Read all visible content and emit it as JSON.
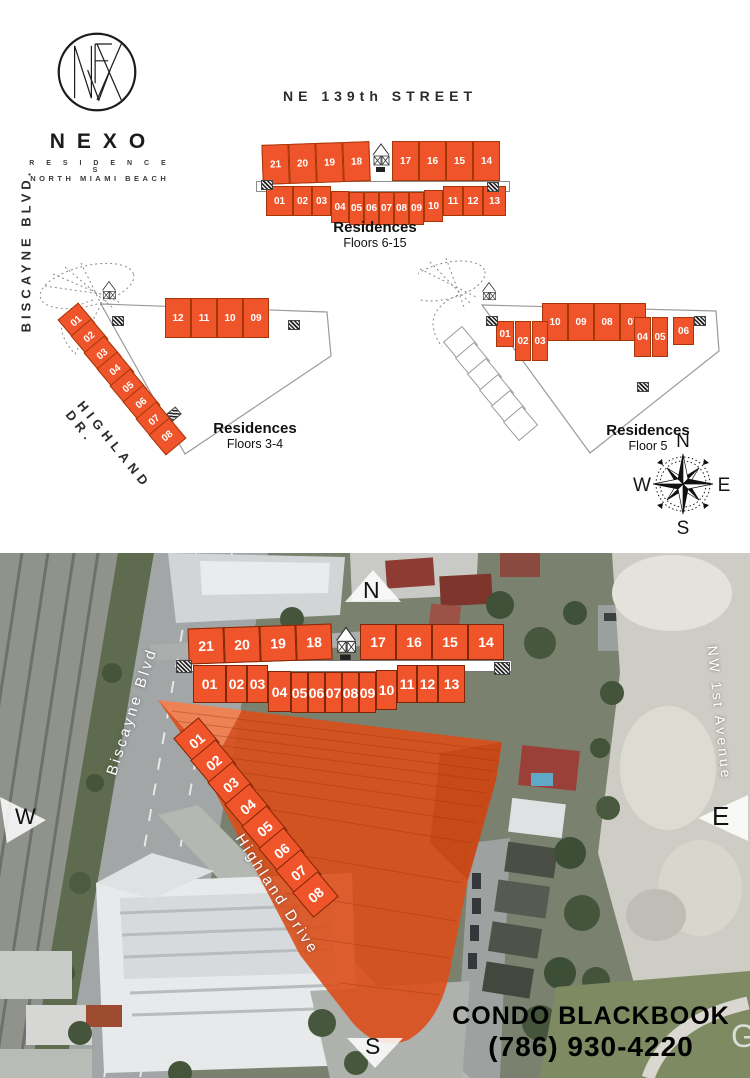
{
  "brand": {
    "name": "NEXO",
    "tagline_line1": "R E S I D E N C E S",
    "tagline_line2": "NORTH MIAMI BEACH"
  },
  "streets": {
    "ne139": "NE 139th STREET",
    "biscayne_blvd_plan": "BISCAYNE BLVD.",
    "highland_dr_plan": "HIGHLAND DR.",
    "biscayne_blvd_aerial": "Biscayne Blvd",
    "highland_drive_aerial": "Highland Drive",
    "nw_first_avenue": "NW 1st Avenue"
  },
  "keyplans": {
    "floors_6_15": {
      "title": "Residences",
      "subtitle": "Floors 6-15",
      "top_row_left": [
        "21",
        "20",
        "19",
        "18"
      ],
      "top_row_right": [
        "17",
        "16",
        "15",
        "14"
      ],
      "bottom_row": [
        "01",
        "02",
        "03",
        "04",
        "05",
        "06",
        "07",
        "08",
        "09",
        "10",
        "11",
        "12",
        "13"
      ]
    },
    "floors_3_4": {
      "title": "Residences",
      "subtitle": "Floors 3-4",
      "top_row_left": [
        "16",
        "15",
        "14",
        "13"
      ],
      "top_row_right": [
        "12",
        "11",
        "10",
        "09"
      ],
      "diagonal_units": [
        "01",
        "02",
        "03",
        "04",
        "05",
        "06",
        "07",
        "08"
      ]
    },
    "floor_5": {
      "title": "Residences",
      "subtitle": "Floor 5",
      "top_row_left": [
        "14",
        "13",
        "12",
        "11"
      ],
      "top_row_right": [
        "10",
        "09",
        "08",
        "07"
      ],
      "cluster_left": [
        "01",
        "02",
        "03"
      ],
      "cluster_right": [
        "04",
        "05",
        "06"
      ]
    }
  },
  "compass": {
    "north": "N",
    "east": "E",
    "south": "S",
    "west": "W"
  },
  "aerial": {
    "top_row_left": [
      "21",
      "20",
      "19",
      "18"
    ],
    "top_row_right": [
      "17",
      "16",
      "15",
      "14"
    ],
    "bottom_row": [
      "01",
      "02",
      "03",
      "04",
      "05",
      "06",
      "07",
      "08",
      "09",
      "10",
      "11",
      "12",
      "13"
    ],
    "diagonal_units": [
      "01",
      "02",
      "03",
      "04",
      "05",
      "06",
      "07",
      "08"
    ],
    "markers": {
      "north": "N",
      "west": "W",
      "east": "E",
      "south": "S"
    },
    "watermark": "G"
  },
  "contact": {
    "name": "CONDO BLACKBOOK",
    "phone": "(786) 930-4220"
  },
  "colors": {
    "unit_orange": "#F0542A",
    "unit_border": "#A63608",
    "overlay_orange": "#DC4E1A"
  }
}
